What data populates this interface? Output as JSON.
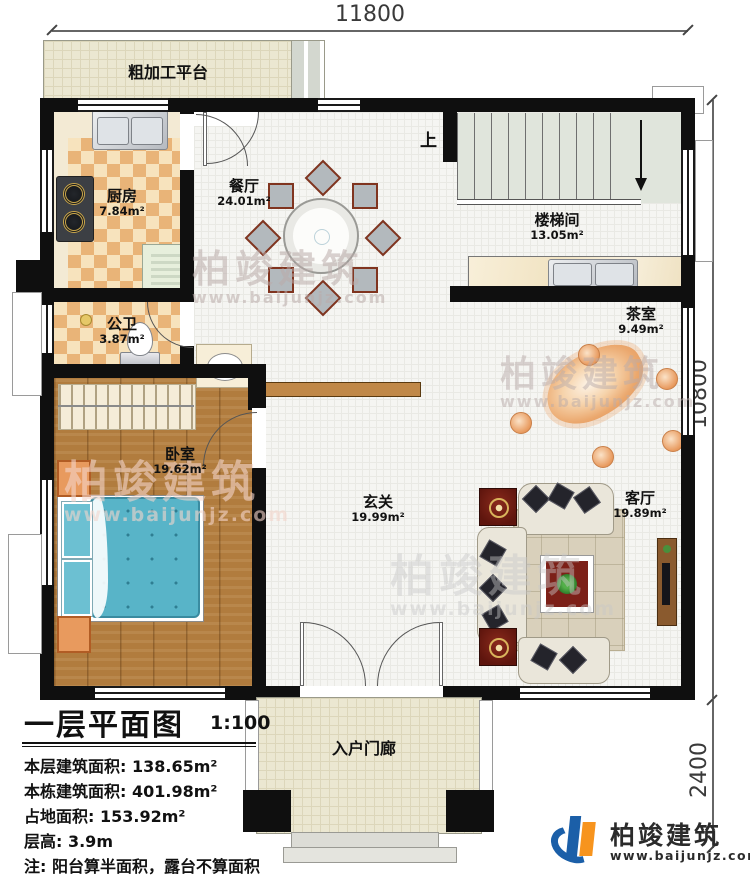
{
  "dimensions": {
    "top": "11800",
    "right_upper": "10800",
    "right_lower": "2400"
  },
  "stairs": {
    "up_label": "上"
  },
  "rooms": {
    "platform": {
      "name": "粗加工平台"
    },
    "kitchen": {
      "name": "厨房",
      "area": "7.84m²"
    },
    "dining": {
      "name": "餐厅",
      "area": "24.01m²"
    },
    "stairwell": {
      "name": "楼梯间",
      "area": "13.05m²"
    },
    "tearoom": {
      "name": "茶室",
      "area": "9.49m²"
    },
    "bathroom": {
      "name": "公卫",
      "area": "3.87m²"
    },
    "bedroom": {
      "name": "卧室",
      "area": "19.62m²"
    },
    "foyer": {
      "name": "玄关",
      "area": "19.99m²"
    },
    "living": {
      "name": "客厅",
      "area": "19.89m²"
    },
    "porch": {
      "name": "入户门廊"
    }
  },
  "title_block": {
    "title": "一层平面图",
    "scale": "1:100",
    "lines": [
      "本层建筑面积: 138.65m²",
      "本栋建筑面积: 401.98m²",
      "占地面积: 153.92m²",
      "层高: 3.9m",
      "注: 阳台算半面积，露台不算面积"
    ]
  },
  "branding": {
    "name": "柏竣建筑",
    "url": "www.baijunjz.com"
  },
  "watermark": {
    "name": "柏竣建筑",
    "url": "www.baijunjz.com"
  },
  "colors": {
    "wall": "#0f0f0f",
    "wood_floor": "#b17c3e",
    "bed": "#58b4c8",
    "platform_floor": "#ebe7d1",
    "stair_tread": "#e0e5dc",
    "logo_blue": "#1b5fa8",
    "logo_orange": "#f7941e"
  }
}
